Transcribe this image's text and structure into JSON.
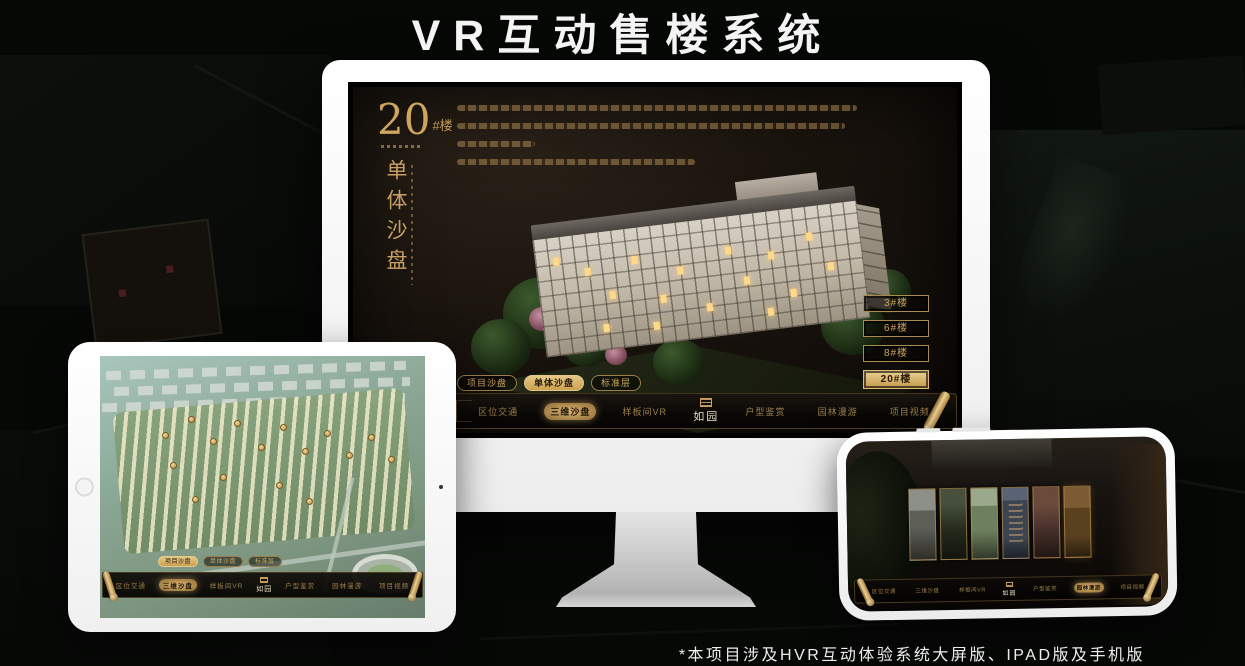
{
  "title": "VR互动售楼系统",
  "footnote": "*本项目涉及HVR互动体验系统大屏版、IPAD版及手机版",
  "screen": {
    "building_no": "20",
    "building_unit": "#楼",
    "mode_title": "单体沙盘"
  },
  "floor_buttons": [
    "3#楼",
    "6#楼",
    "8#楼",
    "20#楼"
  ],
  "tabs": [
    "项目沙盘",
    "单体沙盘",
    "标准层"
  ],
  "nav": {
    "logo": "如园",
    "items": [
      "区位交通",
      "三维沙盘",
      "样板间VR",
      "户型鉴赏",
      "园林漫游",
      "项目视频"
    ]
  },
  "colors": {
    "gold": "#c9a063",
    "gold_bright": "#e6c887",
    "screen_brown": "#1a140e",
    "title_white": "#f4f4f4"
  }
}
